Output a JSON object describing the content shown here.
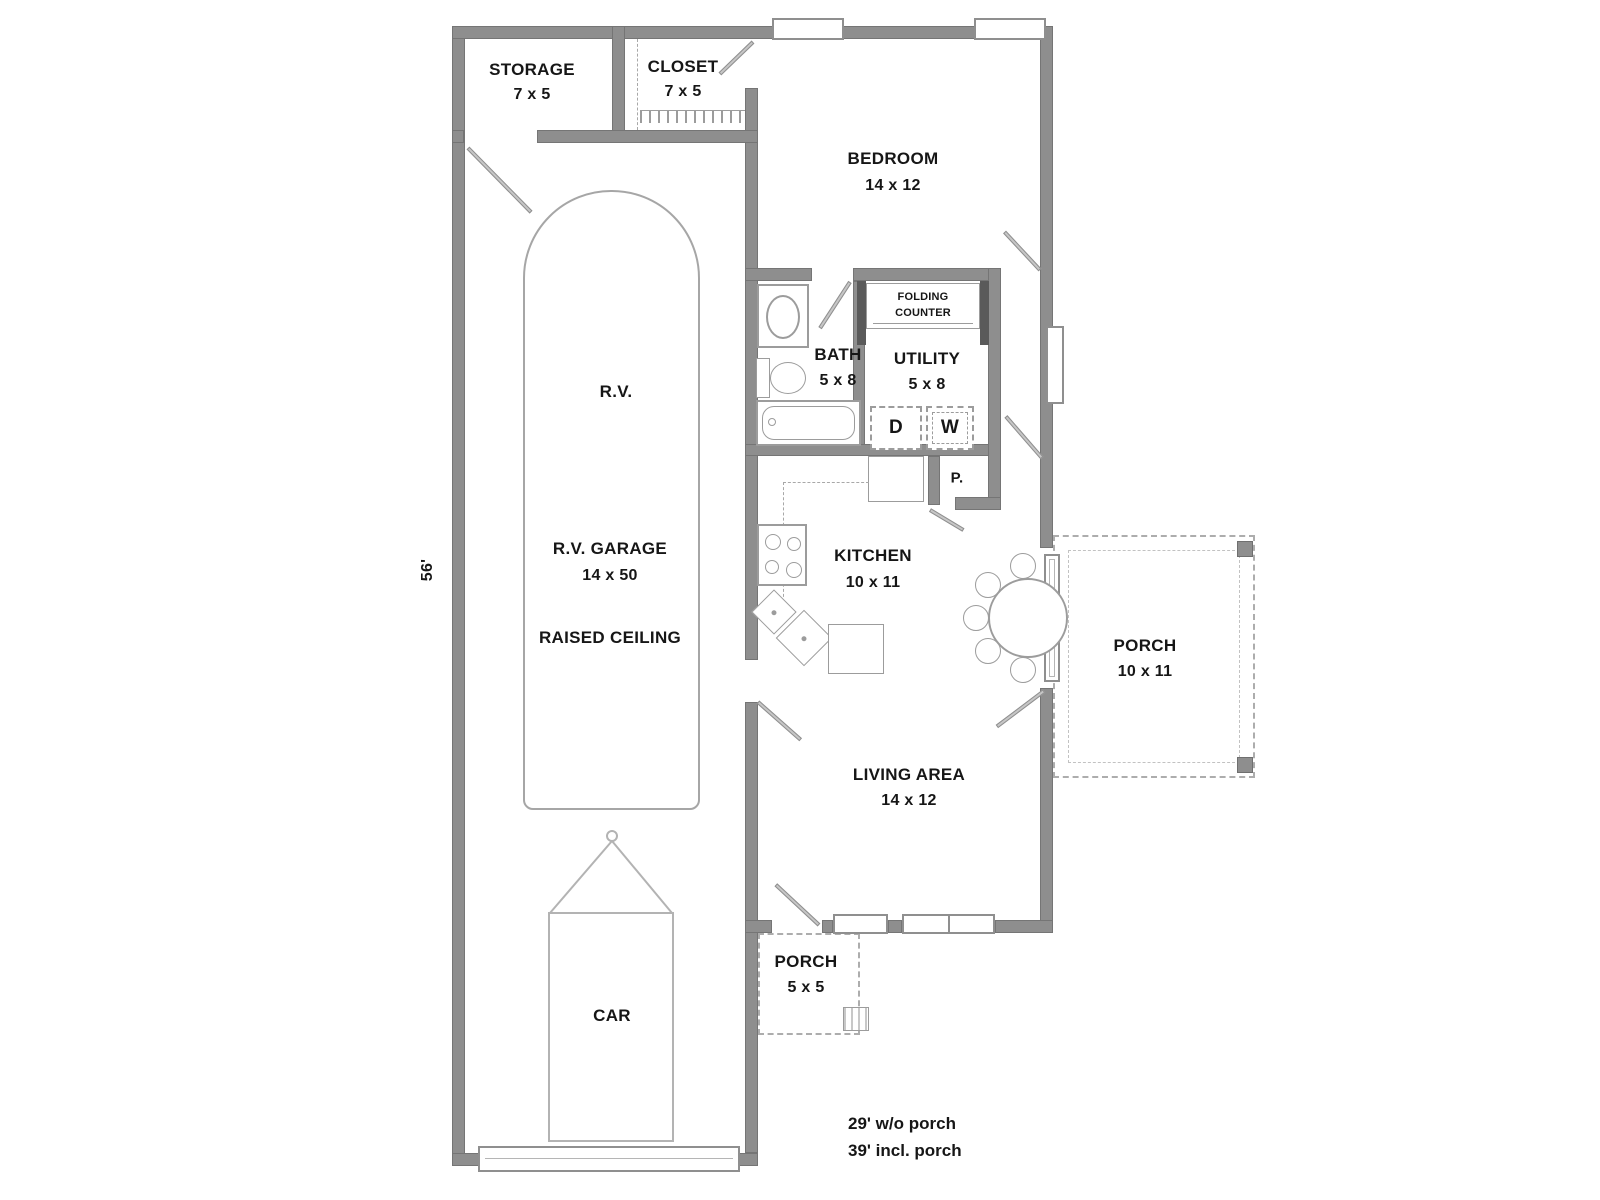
{
  "plan": {
    "rooms": {
      "storage": {
        "name": "STORAGE",
        "dims": "7 x 5"
      },
      "closet": {
        "name": "CLOSET",
        "dims": "7 x 5"
      },
      "bedroom": {
        "name": "BEDROOM",
        "dims": "14 x 12"
      },
      "bath": {
        "name": "BATH",
        "dims": "5 x 8"
      },
      "utility": {
        "name": "UTILITY",
        "dims": "5 x 8"
      },
      "kitchen": {
        "name": "KITCHEN",
        "dims": "10 x 11"
      },
      "living": {
        "name": "LIVING AREA",
        "dims": "14 x 12"
      },
      "porch_side": {
        "name": "PORCH",
        "dims": "10 x 11"
      },
      "porch_front": {
        "name": "PORCH",
        "dims": "5 x 5"
      },
      "rv_garage": {
        "name": "R.V. GARAGE",
        "dims": "14 x 50",
        "note": "RAISED CEILING"
      },
      "pantry": {
        "name": "P."
      }
    },
    "items": {
      "rv": "R.V.",
      "car": "CAR",
      "folding_counter_line1": "FOLDING",
      "folding_counter_line2": "COUNTER",
      "dryer": "D",
      "washer": "W"
    },
    "dimensions": {
      "depth": "56'",
      "width_line1": "29' w/o porch",
      "width_line2": "39' incl. porch"
    },
    "colors": {
      "wall": "#8e8e8e",
      "wall_edge": "#757575",
      "fixture_line": "#9c9c9c",
      "text": "#161616",
      "background": "#ffffff"
    }
  }
}
